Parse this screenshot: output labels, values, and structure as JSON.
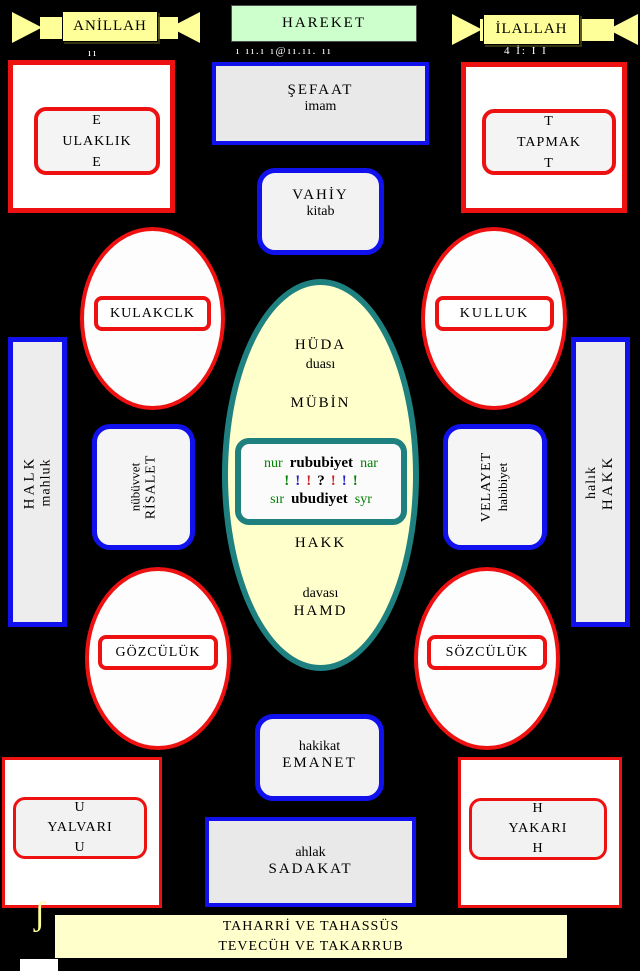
{
  "banners": {
    "left_label": "ANİLLAH",
    "center_label": "HAREKET",
    "right_label": "İLALLAH"
  },
  "fragments": {
    "left": "ıı",
    "center": "ı ıı.ı ı@ıı.ıı.  ıı",
    "right": "4 İ:  I I"
  },
  "top_left_box": {
    "line1": "E",
    "line2": "ULAKLIK",
    "line3": "E"
  },
  "top_right_box": {
    "line1": "T",
    "line2": "TAPMAK",
    "line3": "T"
  },
  "sefaat": {
    "line1": "ŞEFAAT",
    "line2": "imam"
  },
  "vahiy": {
    "line1": "VAHİY",
    "line2": "kitab"
  },
  "ovals": {
    "top_left": "KULAKCLK",
    "top_right": "KULLUK",
    "bottom_left": "GÖZCÜLÜK",
    "bottom_right": "SÖZCÜLÜK"
  },
  "bars": {
    "left": {
      "line1": "HALK",
      "line2": "mahluk"
    },
    "right": {
      "line1": "halık",
      "line2": "HAKK"
    }
  },
  "mid_left": {
    "line1": "nübüvvet",
    "line2": "RİSALET"
  },
  "mid_right": {
    "line1": "VELAYET",
    "line2": "habibiyet"
  },
  "center": {
    "huda": "HÜDA",
    "duasi": "duası",
    "mubin": "MÜBİN",
    "core": {
      "left1": "nur",
      "mid1": "rububiyet",
      "right1": "nar",
      "punct": [
        "!",
        "!",
        "!",
        "?",
        "!",
        "!",
        "!"
      ],
      "punct_colors": [
        "#007F00",
        "#2222CC",
        "#CC2222",
        "#000000",
        "#CC2222",
        "#2222CC",
        "#007F00"
      ],
      "left3": "sır",
      "mid3": "ubudiyet",
      "right3": "syr"
    },
    "hakk": "HAKK",
    "davasi": "davası",
    "hamd": "HAMD"
  },
  "emanet": {
    "line1": "hakikat",
    "line2": "EMANET"
  },
  "sadakat": {
    "line1": "ahlak",
    "line2": "SADAKAT"
  },
  "bottom_left_box": {
    "line1": "U",
    "line2": "YALVARI",
    "line3": "U"
  },
  "bottom_right_box": {
    "line1": "H",
    "line2": "YAKARI",
    "line3": "H"
  },
  "banner_bottom": {
    "line1": "TAHARRİ VE TAHASSÜS",
    "line2": "TEVECÜH VE TAKARRUB"
  },
  "decorations": {
    "left_brace": "ʃ",
    "right_mark": "¬"
  },
  "colors": {
    "background": "#000000",
    "red_border": "#EE1111",
    "blue_border": "#1111EE",
    "teal_border": "#1F8080",
    "ribbon_yellow": "#FFFF99",
    "cream": "#FFFFCC",
    "green_fill": "#CCFFCC",
    "gray_fill": "#E9E9E9",
    "green_text": "#007F00"
  }
}
